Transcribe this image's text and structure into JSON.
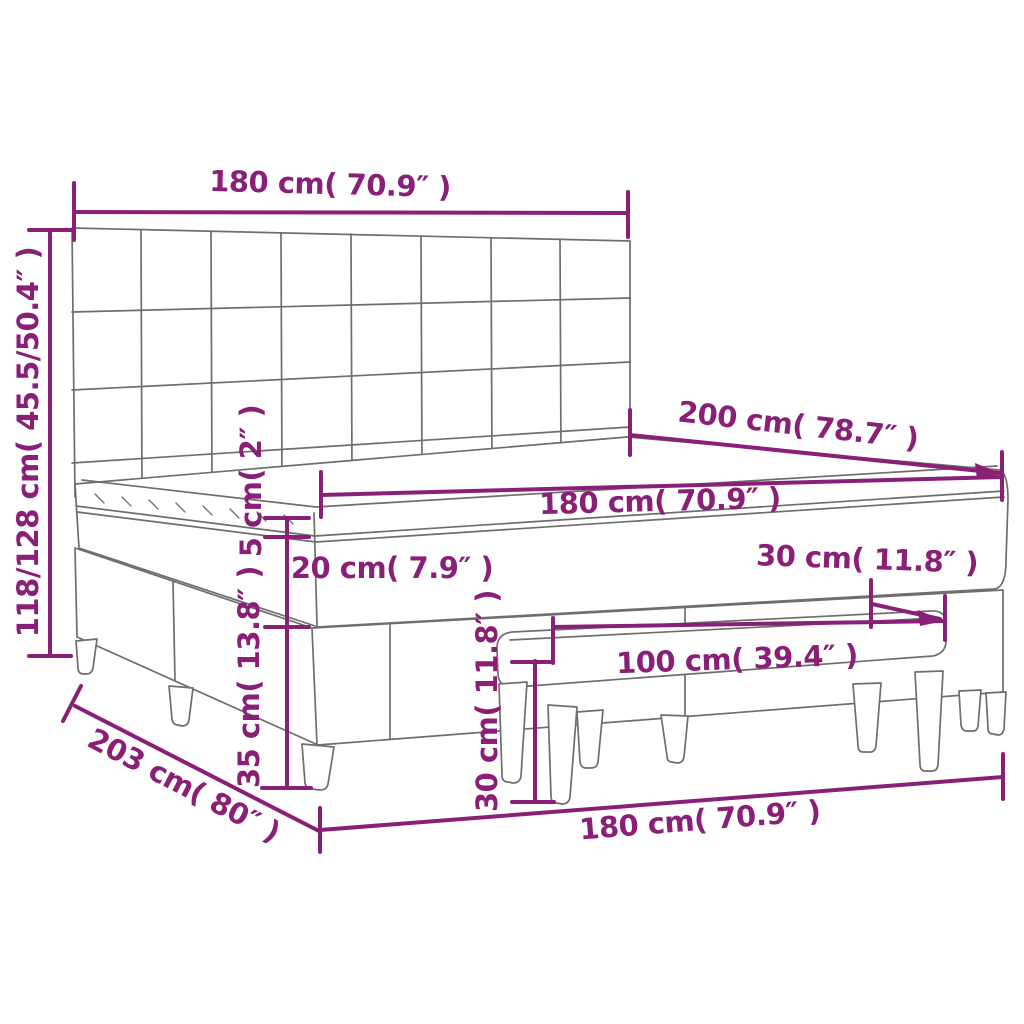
{
  "diagram": {
    "kind": "product-dimension-diagram",
    "subject": "box spring bed with tufted headboard, mattress topper and bench",
    "colors": {
      "accent": "#8a1f78",
      "line": "#6e6e6e",
      "background": "#ffffff"
    },
    "dims": {
      "headboard_width": "180 cm( 70.9″ )",
      "overall_height": "118/128 cm( 45.5/50.4″ )",
      "bed_depth": "200 cm( 78.7″ )",
      "mattress_width": "180 cm( 70.9″ )",
      "topper_thickness": "5 cm( 2″ )",
      "mattress_thickness": "20 cm( 7.9″ )",
      "base_height": "35 cm( 13.8″ )",
      "bench_height": "30 cm( 11.8″ )",
      "bench_length": "100 cm( 39.4″ )",
      "side_clearance": "30 cm( 11.8″ )",
      "frame_width": "180 cm( 70.9″ )",
      "frame_depth": "203 cm( 80″ )"
    }
  }
}
